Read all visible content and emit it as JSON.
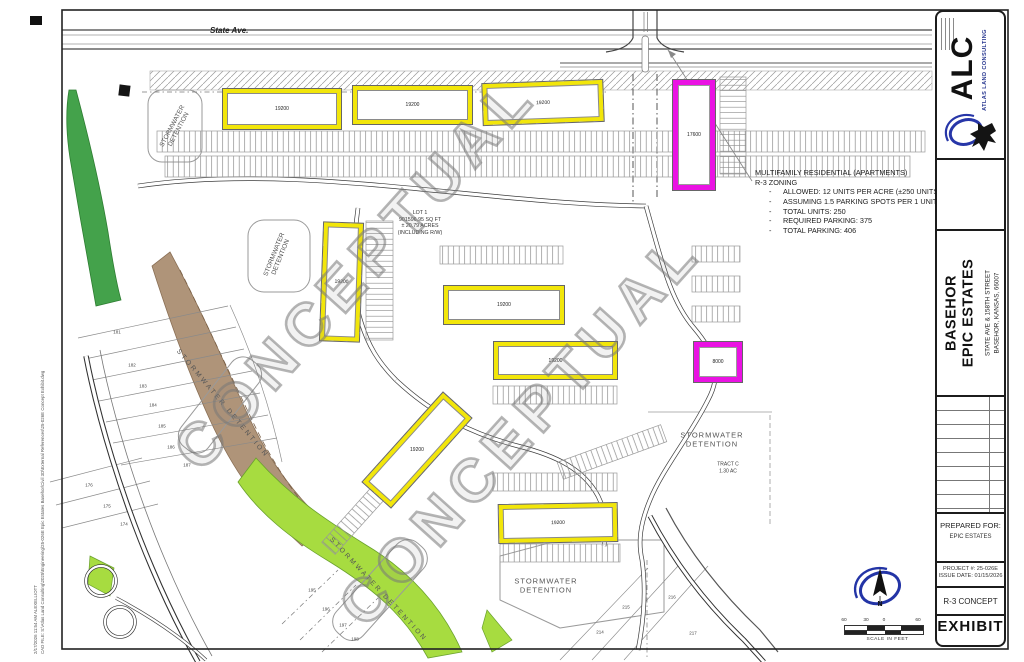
{
  "plan": {
    "road_label": "State Ave.",
    "watermark": "CONCEPTUAL",
    "detention_label": "STORMWATER DETENTION",
    "lot_note": {
      "lines": [
        "LOT 1",
        "901596.95 SQ FT",
        "± 20.79 ACRES",
        "(INCLUDING R/W)"
      ]
    },
    "tract_label": {
      "line1": "TRACT C",
      "line2": "1.30 AC"
    },
    "zoning_note": {
      "title": "MULTIFAMILY RESIDENTIAL (APARTMENTS)",
      "subtitle": "R-3 ZONING",
      "bullet_char": "-",
      "bullets": [
        "ALLOWED: 12 UNITS PER ACRE (±250 UNITS)",
        "ASSUMING 1.5 PARKING SPOTS PER 1 UNIT",
        "TOTAL UNITS: 250",
        "REQUIRED PARKING: 375",
        "TOTAL PARKING: 406"
      ]
    },
    "buildings": [
      {
        "label": "19200"
      },
      {
        "label": "19200"
      },
      {
        "label": "19200"
      },
      {
        "label": "19200"
      },
      {
        "label": "19200"
      },
      {
        "label": "19200"
      },
      {
        "label": "19200"
      },
      {
        "label": "19200"
      },
      {
        "label": "17600"
      },
      {
        "label": "8000"
      }
    ],
    "parcels": [
      {
        "n": "181"
      },
      {
        "n": "182"
      },
      {
        "n": "183"
      },
      {
        "n": "184"
      },
      {
        "n": "185"
      },
      {
        "n": "186"
      },
      {
        "n": "187"
      },
      {
        "n": "176"
      },
      {
        "n": "175"
      },
      {
        "n": "174"
      },
      {
        "n": "195"
      },
      {
        "n": "196"
      },
      {
        "n": "197"
      },
      {
        "n": "198"
      },
      {
        "n": "215"
      },
      {
        "n": "214"
      },
      {
        "n": "216"
      },
      {
        "n": "217"
      }
    ],
    "colors": {
      "building_yellow": "#f2e60a",
      "building_magenta": "#ea12e3",
      "green_dark": "#44a24b",
      "green_bright": "#a7dc40",
      "channel_brown": "#a88b6e",
      "watermark_gray": "#8f8f8f",
      "logo_blue": "#2736a8"
    }
  },
  "titleblock": {
    "firm_abbr": "ALC",
    "firm_name": "ATLAS LAND CONSULTING",
    "project_title_line1": "BASEHOR",
    "project_title_line2": "EPIC ESTATES",
    "address_line1": "STATE AVE & 158TH STREET",
    "address_line2": "BASEHOR, KANSAS, 66007",
    "prepared_for_label": "PREPARED FOR:",
    "prepared_for": "EPIC ESTATES",
    "project_no": "PROJECT #: 25-026E",
    "issue_date": "ISSUE DATE: 01/15/2026",
    "sheet_title": "R-3 CONCEPT",
    "sheet_type": "EXHIBIT"
  },
  "north": {
    "label": "N"
  },
  "scalebar": {
    "labels": [
      "60",
      "30",
      "0",
      "60"
    ],
    "caption": "SCALE IN FEET"
  },
  "stamp": {
    "line1": "2/17/2026 11:54 AM  ALEXELLIOTT",
    "line2": "CAD FILE: S:\\Atlas Land Consulting\\2025\\Engineering\\25-026E Epic Estates Basehor\\Civil 3D\\External References\\25-026E Concept Exhibit.dwg"
  }
}
